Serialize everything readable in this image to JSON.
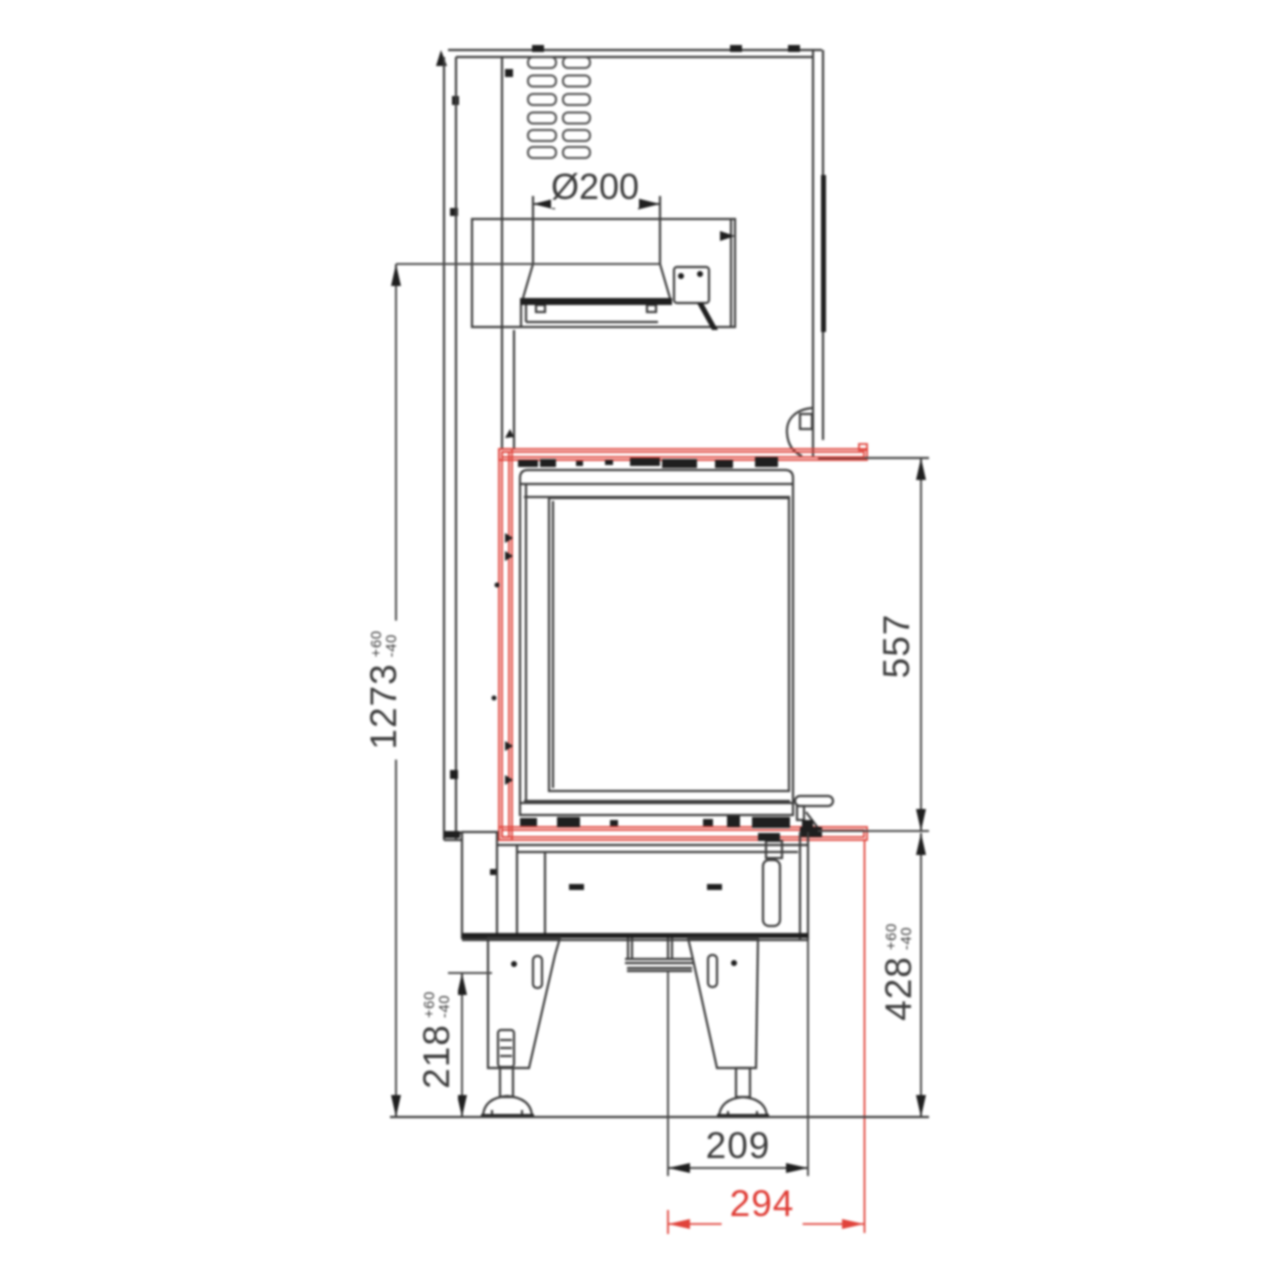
{
  "title": "fireplace-insert-side-elevation-technical-drawing",
  "colors": {
    "line": "#3d3d3d",
    "accent_red": "#e0433b",
    "text": "#3b3b3b",
    "red_text": "#df3b34"
  },
  "dimensions": {
    "flue_diameter": {
      "label": "Ø200"
    },
    "height_total": {
      "value": "1273",
      "tol_plus": "+60",
      "tol_minus": "-40"
    },
    "height_firebox": {
      "value": "557"
    },
    "height_base": {
      "value": "428",
      "tol_plus": "+60",
      "tol_minus": "-40"
    },
    "height_legs": {
      "value": "218",
      "tol_plus": "+60",
      "tol_minus": "-40"
    },
    "width_feet": {
      "value": "209"
    },
    "width_frame": {
      "value": "294"
    }
  }
}
